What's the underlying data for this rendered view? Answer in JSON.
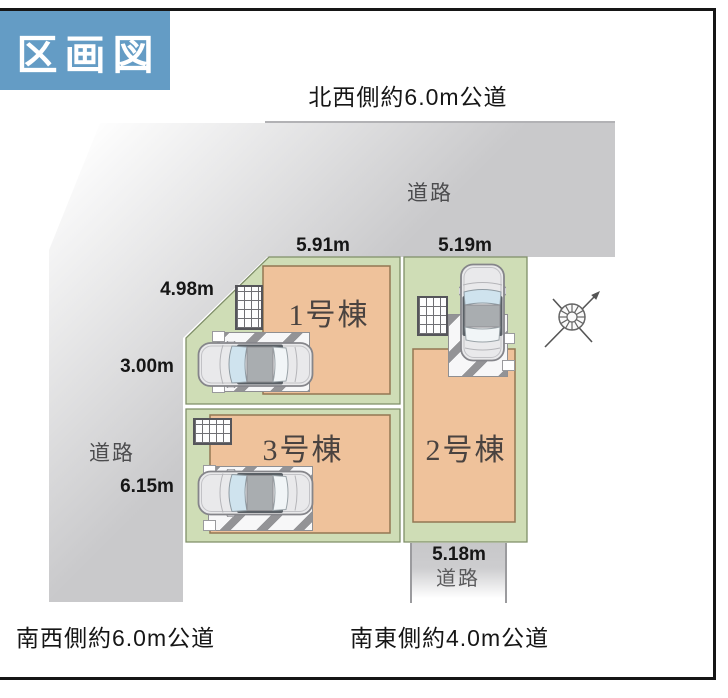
{
  "title": "区画図",
  "roads": {
    "northwest": "北西側約6.0m公道",
    "southwest": "南西側約6.0m公道",
    "southeast": "南東側約4.0m公道",
    "top_label": "道路",
    "left_label": "道路",
    "bottom_label": "道路"
  },
  "measurements": {
    "lot1_top": "5.91m",
    "lot2_top": "5.19m",
    "lot1_diagonal": "4.98m",
    "lot1_left": "3.00m",
    "lot3_left": "6.15m",
    "lot2_bottom": "5.18m"
  },
  "buildings": {
    "building1": "1号棟",
    "building2": "2号棟",
    "building3": "3号棟"
  },
  "icons": {
    "compass": "compass-north-arrow",
    "car": "car-top-view"
  },
  "colors": {
    "title_bg": "#649cc5",
    "road_gray": "#c9c9cb",
    "lot_green": "#cfddb6",
    "building_fill": "#efc29b",
    "frame": "#161616"
  }
}
